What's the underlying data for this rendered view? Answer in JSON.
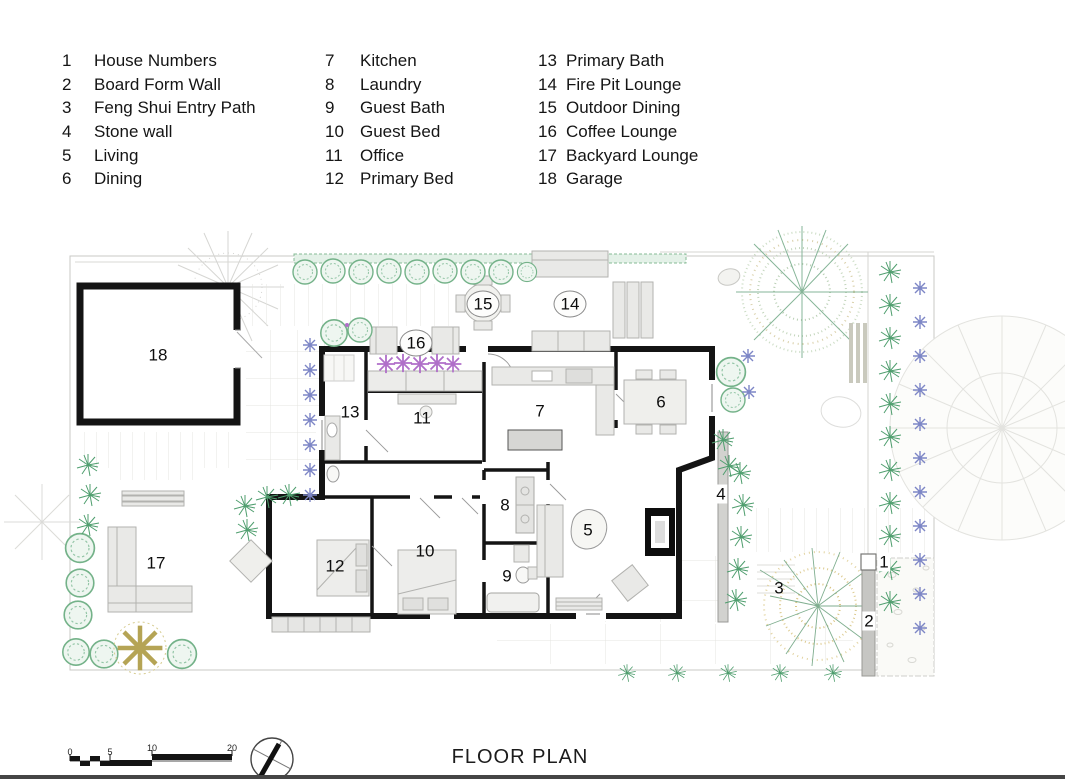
{
  "legend": {
    "items": [
      {
        "num": "1",
        "label": "House Numbers"
      },
      {
        "num": "2",
        "label": "Board Form Wall"
      },
      {
        "num": "3",
        "label": "Feng Shui Entry Path"
      },
      {
        "num": "4",
        "label": "Stone wall"
      },
      {
        "num": "5",
        "label": "Living"
      },
      {
        "num": "6",
        "label": "Dining"
      },
      {
        "num": "7",
        "label": "Kitchen"
      },
      {
        "num": "8",
        "label": "Laundry"
      },
      {
        "num": "9",
        "label": "Guest Bath"
      },
      {
        "num": "10",
        "label": "Guest Bed"
      },
      {
        "num": "11",
        "label": "Office"
      },
      {
        "num": "12",
        "label": "Primary Bed"
      },
      {
        "num": "13",
        "label": "Primary Bath"
      },
      {
        "num": "14",
        "label": "Fire Pit Lounge"
      },
      {
        "num": "15",
        "label": "Outdoor Dining"
      },
      {
        "num": "16",
        "label": "Coffee Lounge"
      },
      {
        "num": "17",
        "label": "Backyard Lounge"
      },
      {
        "num": "18",
        "label": "Garage"
      }
    ]
  },
  "plan": {
    "markers": [
      {
        "num": "1"
      },
      {
        "num": "2"
      },
      {
        "num": "3"
      },
      {
        "num": "4"
      },
      {
        "num": "5"
      },
      {
        "num": "6"
      },
      {
        "num": "7"
      },
      {
        "num": "8"
      },
      {
        "num": "9"
      },
      {
        "num": "10"
      },
      {
        "num": "11"
      },
      {
        "num": "12"
      },
      {
        "num": "13"
      },
      {
        "num": "14"
      },
      {
        "num": "15"
      },
      {
        "num": "16"
      },
      {
        "num": "17"
      },
      {
        "num": "18"
      }
    ]
  },
  "footer": {
    "title": "FLOOR PLAN",
    "scale_ticks": [
      "0",
      "5",
      "10",
      "20"
    ]
  },
  "colors": {
    "wall": "#141414",
    "boundary": "#c8c8c6",
    "bush_green": "#74b289",
    "fern_green": "#4f9e6e",
    "plant_blue": "#7d86c6",
    "flower_purple": "#b06fc9",
    "tree_tan": "#d8c27f",
    "furniture": "#e9e9e7"
  }
}
